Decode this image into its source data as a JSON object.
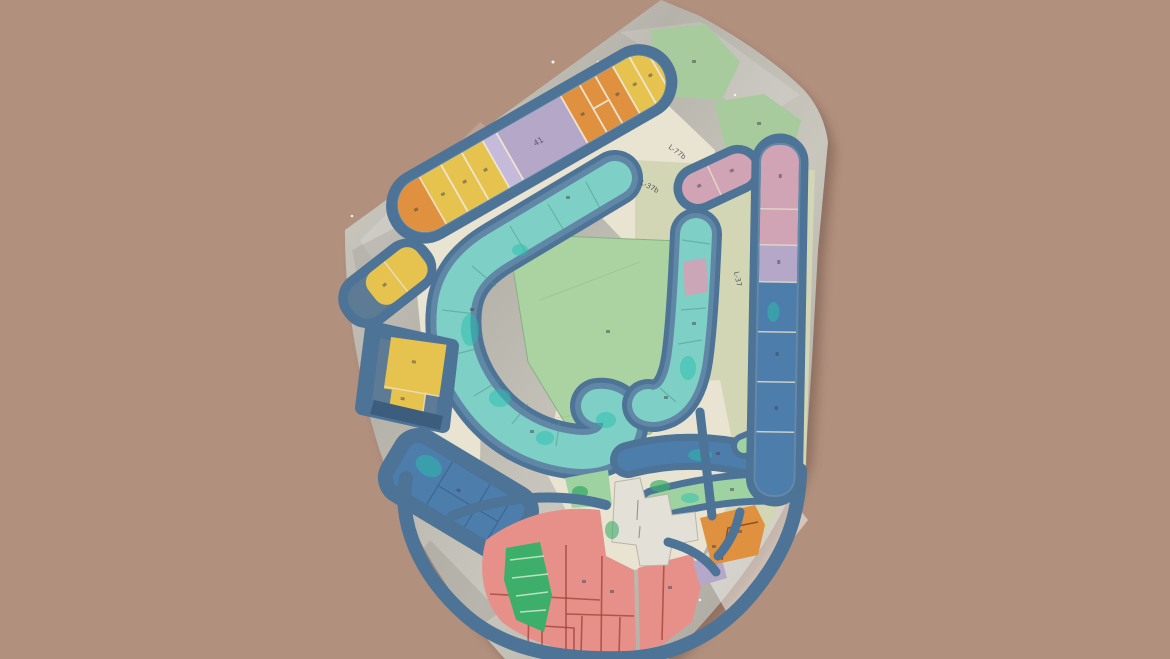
{
  "image": {
    "width": 1170,
    "height": 659,
    "subject": "photograph of a physical site-plan architecture model on a foil base"
  },
  "colors": {
    "mauve": "#b2907e",
    "shadow": "#4a3328",
    "foil_light": "#d8d5cd",
    "foil_mid": "#b9b6ae",
    "foil_dark": "#9c9890",
    "foil_bright": "#f0efeb",
    "road_cream": "#e9e3d1",
    "road_sage": "#d3d6b4",
    "wall": "#4d7396",
    "wall_light": "#7b9fba",
    "wall_dark": "#2f4e6b",
    "teal_band": "#7ecfc5",
    "teal_paint": "#27bfae",
    "field_green": "#abd3a2",
    "flat_green": "#a8cb9d",
    "band_green": "#9ed2a0",
    "bright_green": "#3eae6b",
    "yellow": "#e6c34e",
    "orange": "#e0913f",
    "lavender": "#b4a7c7",
    "lavender_light": "#c6badb",
    "pink_lot": "#d0a3b5",
    "salmon": "#e69089",
    "salmon_line": "#9c4138",
    "blue_zone": "#4c7dab",
    "blue_zone_dark": "#2d5680",
    "slate_floor": "#5d7b95",
    "navy_strip": "#3c5d7e",
    "plaza": "#e3e0d7",
    "ink": "#3c4349",
    "lot_gap": "#e8e0ce"
  },
  "labels": {
    "road_label_1": "L-77b",
    "road_label_2": "L-37b",
    "road_label_3": "L-37",
    "lavender_strip_number": "41"
  }
}
